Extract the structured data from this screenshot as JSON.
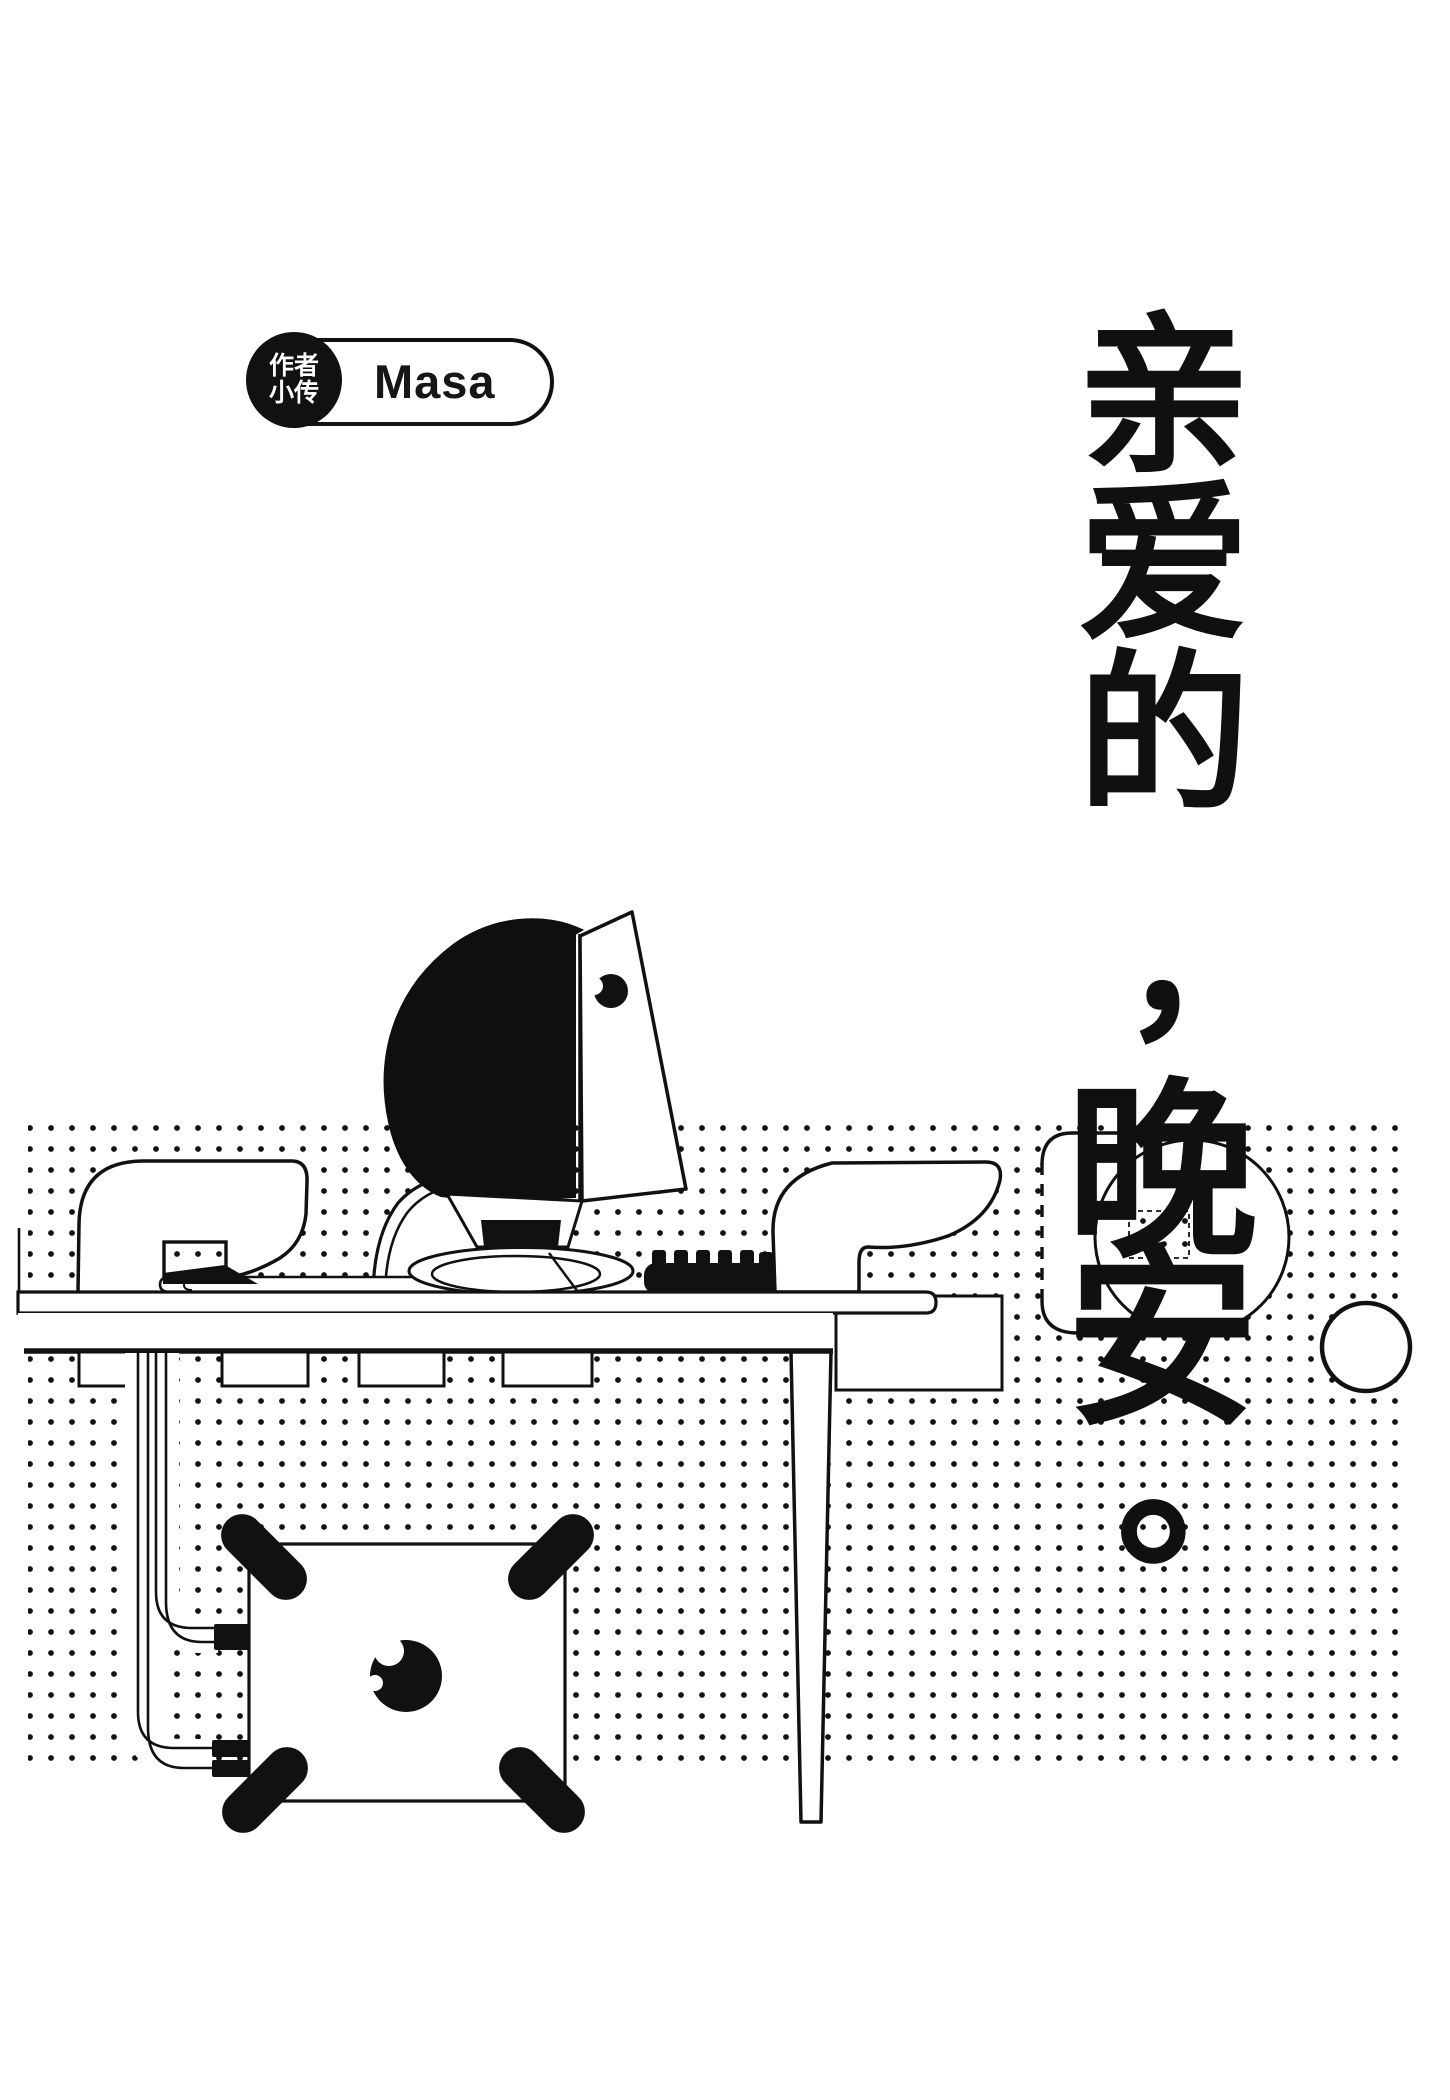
{
  "page": {
    "background": "#ffffff",
    "ink": "#111111"
  },
  "badge": {
    "tag_line1": "作者",
    "tag_line2": "小传",
    "name": "Masa"
  },
  "verse": {
    "text": "亲爱的，晚安。",
    "chars": [
      "亲",
      "爱",
      "的",
      "，",
      "晚",
      "安",
      "。"
    ]
  },
  "scene": {
    "description": "black-and-white illustration of an iMac-style computer on a desk with keyboard, two chairs, cables running down to a subwoofer box, halftone dot background, speech bubble and small circles",
    "icons": [
      "imac-computer-icon",
      "keyboard-icon",
      "office-chair-icon",
      "desk-icon",
      "subwoofer-icon",
      "cable-icon",
      "speech-bubble-icon",
      "halftone-dots",
      "moon-dot-icon"
    ]
  }
}
